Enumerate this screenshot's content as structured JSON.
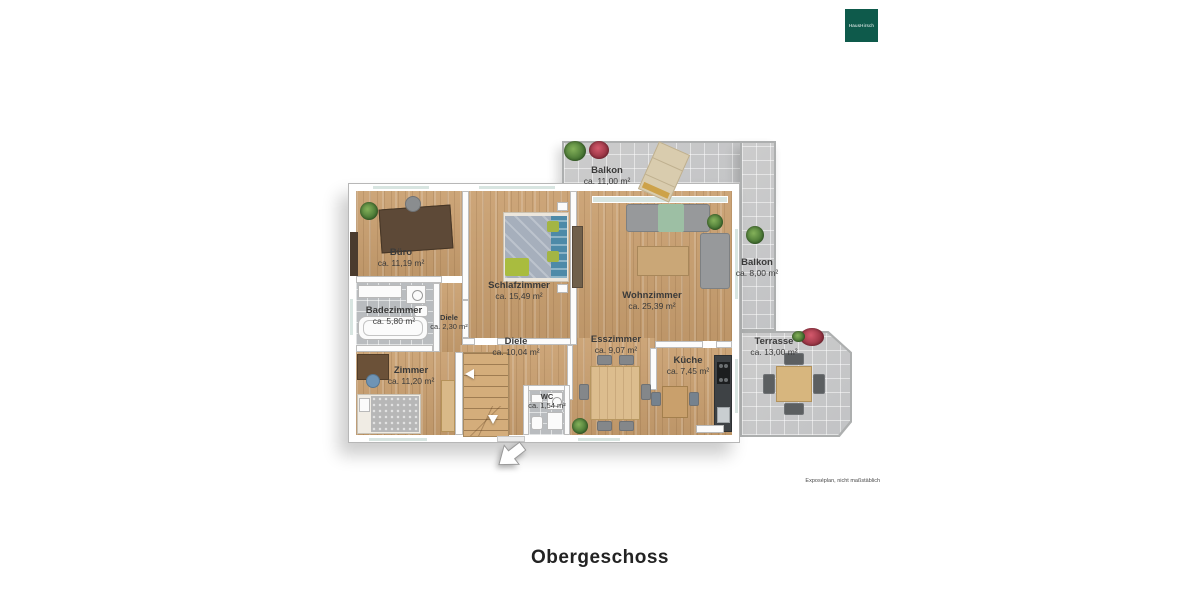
{
  "brand": {
    "logo_text": "HausHirsch",
    "logo_bg": "#0e5a4b"
  },
  "footer": {
    "title": "Obergeschoss",
    "disclaimer": "Exposéplan, nicht maßstäblich"
  },
  "colors": {
    "wood_floor": "#c99f6f",
    "outdoor_tile": "#c8c9ca",
    "bath_tile": "#b9bcbf",
    "wall": "#fcfcfc",
    "window_glass": "#d8e5e1",
    "label_text": "#3a3a3a"
  },
  "rooms": {
    "balkon_top": {
      "name": "Balkon",
      "area": "ca. 11,00 m²"
    },
    "balkon_right": {
      "name": "Balkon",
      "area": "ca. 8,00 m²"
    },
    "terrasse": {
      "name": "Terrasse",
      "area": "ca. 13,00 m²"
    },
    "buero": {
      "name": "Büro",
      "area": "ca. 11,19 m²"
    },
    "schlafzimmer": {
      "name": "Schlafzimmer",
      "area": "ca. 15,49 m²"
    },
    "wohnzimmer": {
      "name": "Wohnzimmer",
      "area": "ca. 25,39 m²"
    },
    "badezimmer": {
      "name": "Badezimmer",
      "area": "ca. 5,80 m²"
    },
    "diele_klein": {
      "name": "Diele",
      "area": "ca. 2,30 m²"
    },
    "diele": {
      "name": "Diele",
      "area": "ca. 10,04 m²"
    },
    "zimmer": {
      "name": "Zimmer",
      "area": "ca. 11,20 m²"
    },
    "wc": {
      "name": "WC",
      "area": "ca. 1,54 m²"
    },
    "esszimmer": {
      "name": "Esszimmer",
      "area": "ca. 9,07 m²"
    },
    "kueche": {
      "name": "Küche",
      "area": "ca. 7,45 m²"
    }
  }
}
